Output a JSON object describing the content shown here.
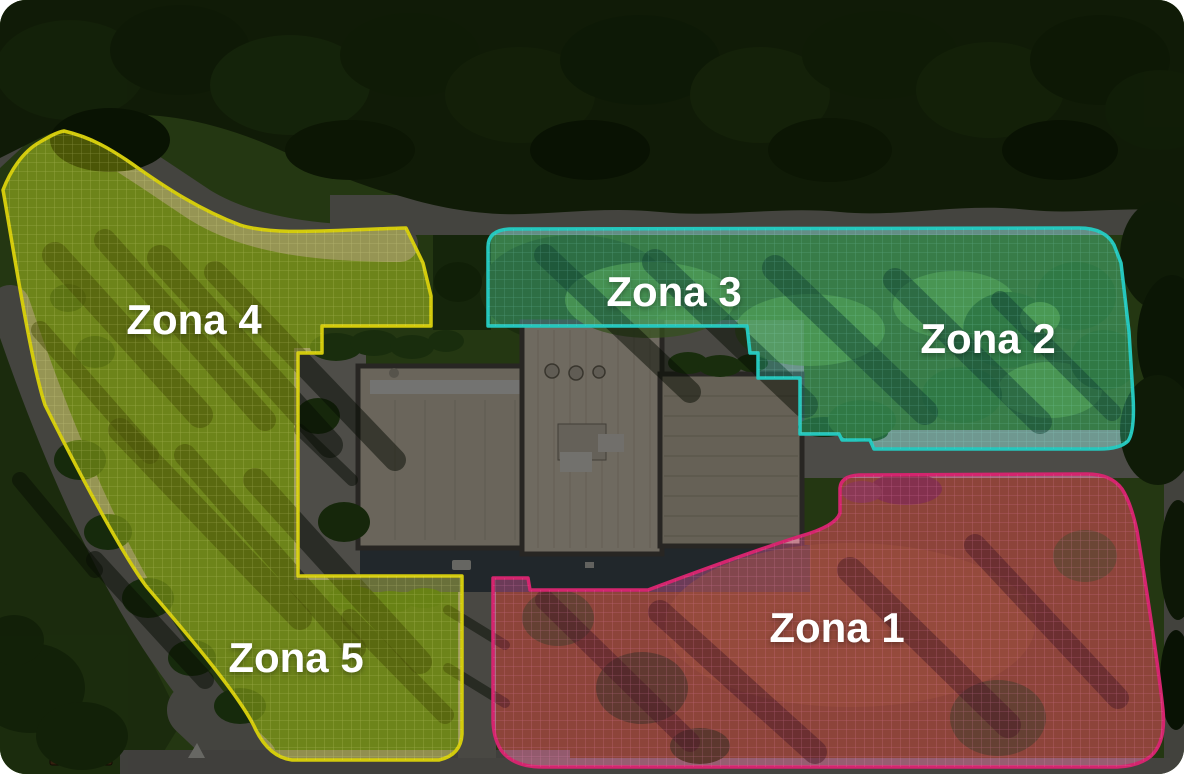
{
  "text_color": "#ffffff",
  "zones": [
    {
      "id": "zona-1",
      "label": "Zona 1",
      "border_color": "#d4256e",
      "fill_color": "rgba(208,35,110,0.32)"
    },
    {
      "id": "zona-2",
      "label": "Zona 2",
      "border_color": "#25c7bd",
      "fill_color": "rgba(30,195,185,0.26)"
    },
    {
      "id": "zona-3",
      "label": "Zona 3",
      "border_color": "#25c7bd",
      "fill_color": "rgba(30,195,185,0.26)"
    },
    {
      "id": "zona-4",
      "label": "Zona 4",
      "border_color": "#d3cb0c",
      "fill_color": "rgba(210,205,10,0.30)"
    },
    {
      "id": "zona-5",
      "label": "Zona 5",
      "border_color": "#d3cb0c",
      "fill_color": "rgba(210,205,10,0.30)"
    }
  ]
}
